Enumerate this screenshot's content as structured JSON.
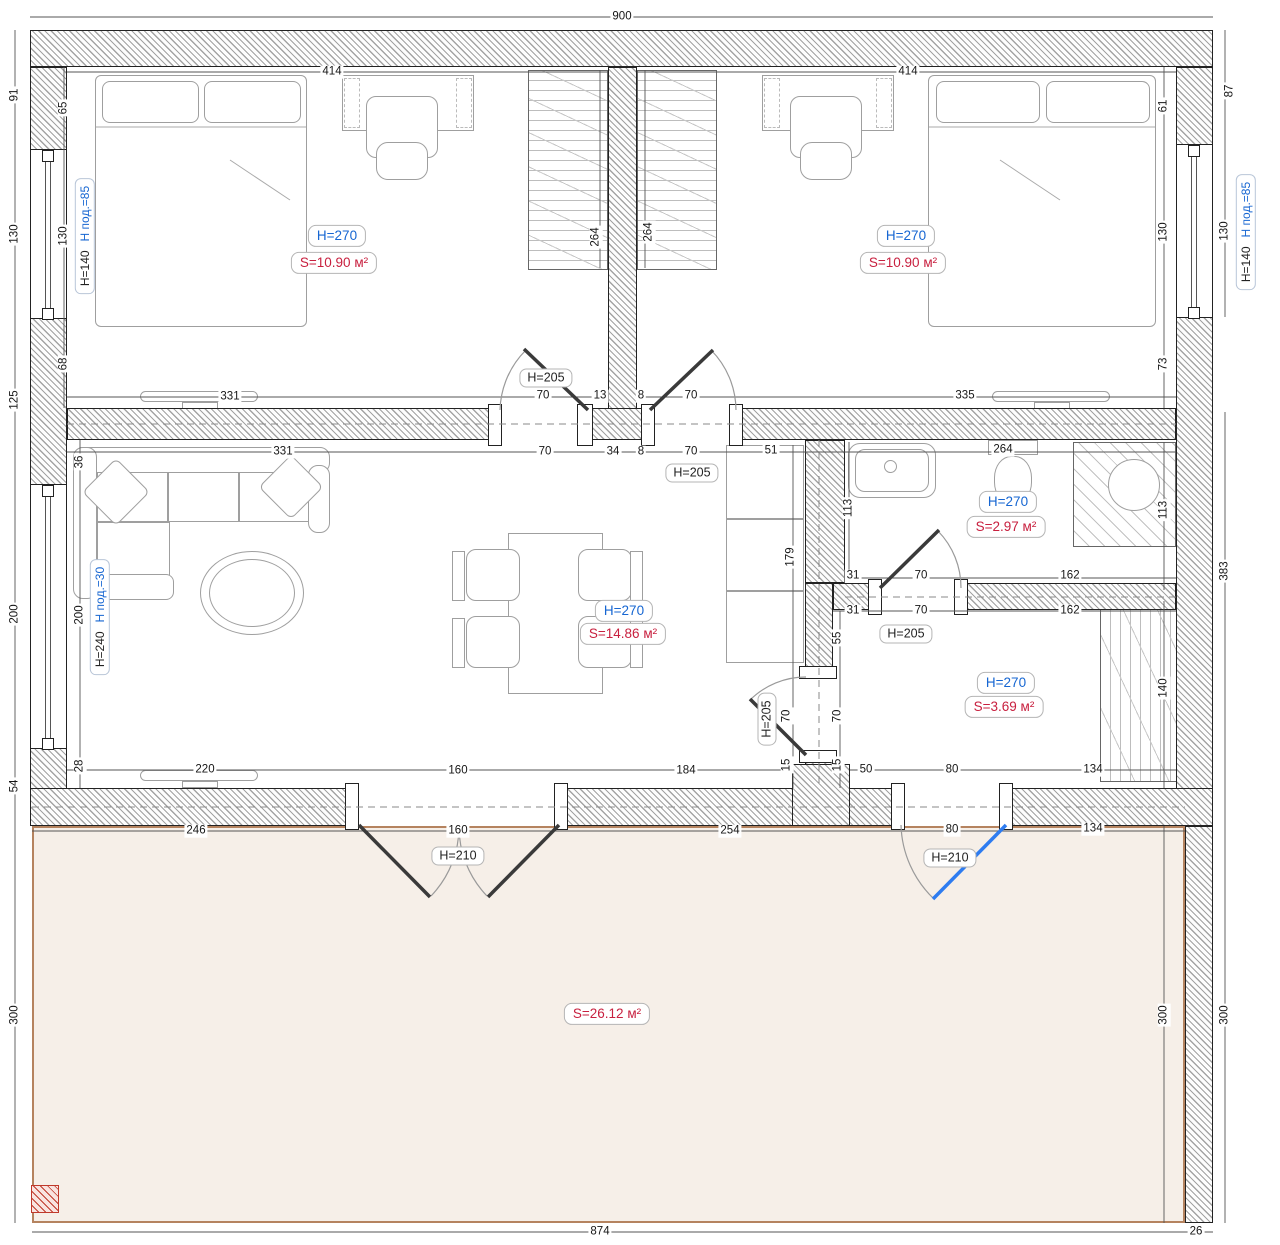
{
  "colors": {
    "accent_blue": "#1666d2",
    "accent_red": "#c8203f",
    "door_blue": "#2e7cf0",
    "terrace_fill": "#f6efe8",
    "terrace_line": "#b5835f",
    "red_square": "#c0392b",
    "wall_line": "#222222",
    "hatch": "#a3a3a3"
  },
  "dims": [
    "900",
    "91",
    "130",
    "125",
    "200",
    "54",
    "300",
    "65",
    "130",
    "68",
    "36",
    "200",
    "28",
    "414",
    "414",
    "264",
    "264",
    "61",
    "130",
    "73",
    "87",
    "130",
    "383",
    "300",
    "331",
    "70",
    "13",
    "8",
    "70",
    "335",
    "331",
    "70",
    "34",
    "8",
    "70",
    "51",
    "264",
    "113",
    "113",
    "179",
    "31",
    "70",
    "162",
    "31",
    "70",
    "162",
    "55",
    "70",
    "15",
    "70",
    "15",
    "140",
    "220",
    "160",
    "184",
    "50",
    "80",
    "134",
    "246",
    "160",
    "254",
    "80",
    "134",
    "300",
    "874",
    "26"
  ],
  "tags": [
    {
      "text": "H=270",
      "color": "blue"
    },
    {
      "text": "S=10.90 м²",
      "color": "red"
    },
    {
      "text": "H=270",
      "color": "blue"
    },
    {
      "text": "S=10.90 м²",
      "color": "red"
    },
    {
      "text": "H=270",
      "color": "blue"
    },
    {
      "text": "S=14.86 м²",
      "color": "red"
    },
    {
      "text": "H=270",
      "color": "blue"
    },
    {
      "text": "S=2.97 м²",
      "color": "red"
    },
    {
      "text": "H=270",
      "color": "blue"
    },
    {
      "text": "S=3.69 м²",
      "color": "red"
    },
    {
      "text": "S=26.12 м²",
      "color": "red"
    }
  ],
  "door_tags": [
    {
      "text": "H=205"
    },
    {
      "text": "H=205"
    },
    {
      "text": "H=205"
    },
    {
      "text": "H=205"
    },
    {
      "text": "H=210"
    },
    {
      "text": "H=210"
    }
  ],
  "window_tags": [
    {
      "main": "H=140",
      "sub": "H под.=85"
    },
    {
      "main": "H=240",
      "sub": "H под.=30"
    },
    {
      "main": "H=140",
      "sub": "H под.=85"
    }
  ]
}
